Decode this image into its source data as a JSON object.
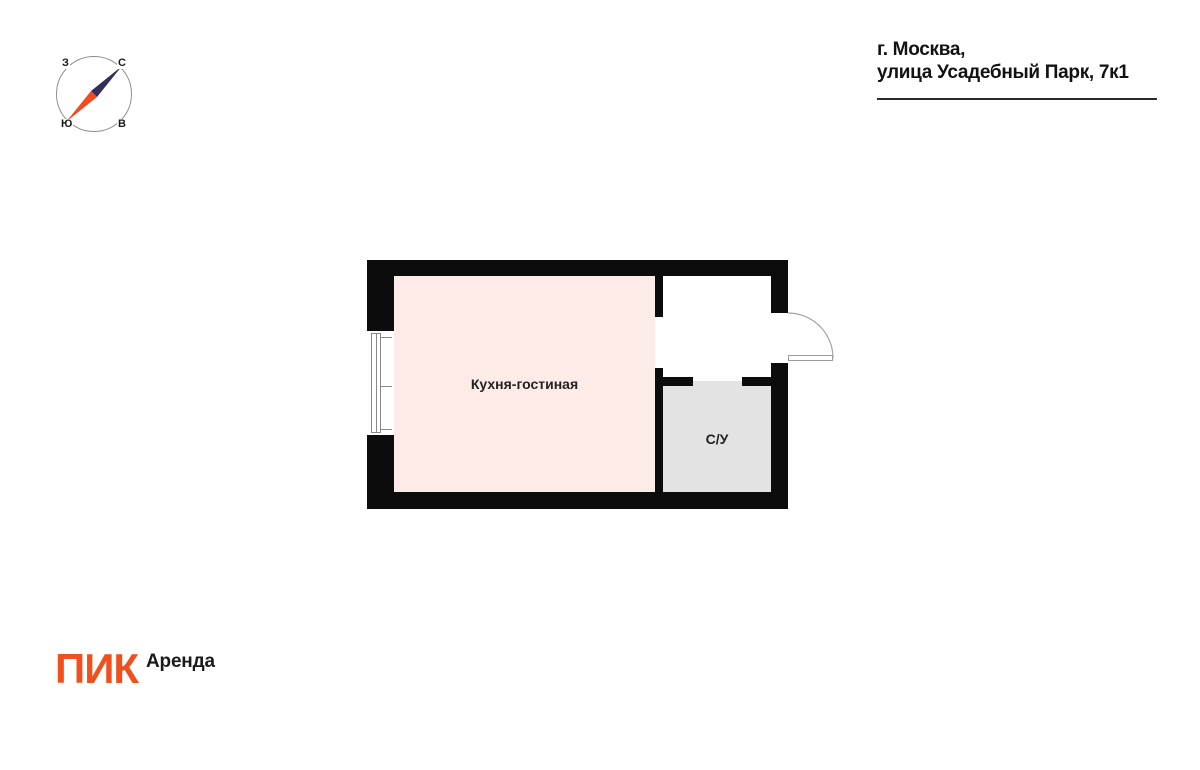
{
  "header": {
    "address_line1": "г. Москва,",
    "address_line2": "улица Усадебный Парк, 7к1"
  },
  "compass": {
    "labels": {
      "west": "З",
      "north": "С",
      "south": "Ю",
      "east": "В"
    },
    "needle_north_color": "#312f5e",
    "needle_south_color": "#f04b22",
    "circle_color": "#8f8f8f"
  },
  "floor_plan": {
    "wall_color": "#0c0c0c",
    "rooms": [
      {
        "name": "kitchen-living-room",
        "label": "Кухня-гостиная",
        "fill": "#fcebe6"
      },
      {
        "name": "bathroom",
        "label": "С/У",
        "fill": "#e3e3e3"
      },
      {
        "name": "hallway",
        "label": "",
        "fill": "#ffffff"
      }
    ]
  },
  "footer": {
    "brand": "ПИК",
    "product": "Аренда",
    "brand_color": "#f0501e"
  }
}
